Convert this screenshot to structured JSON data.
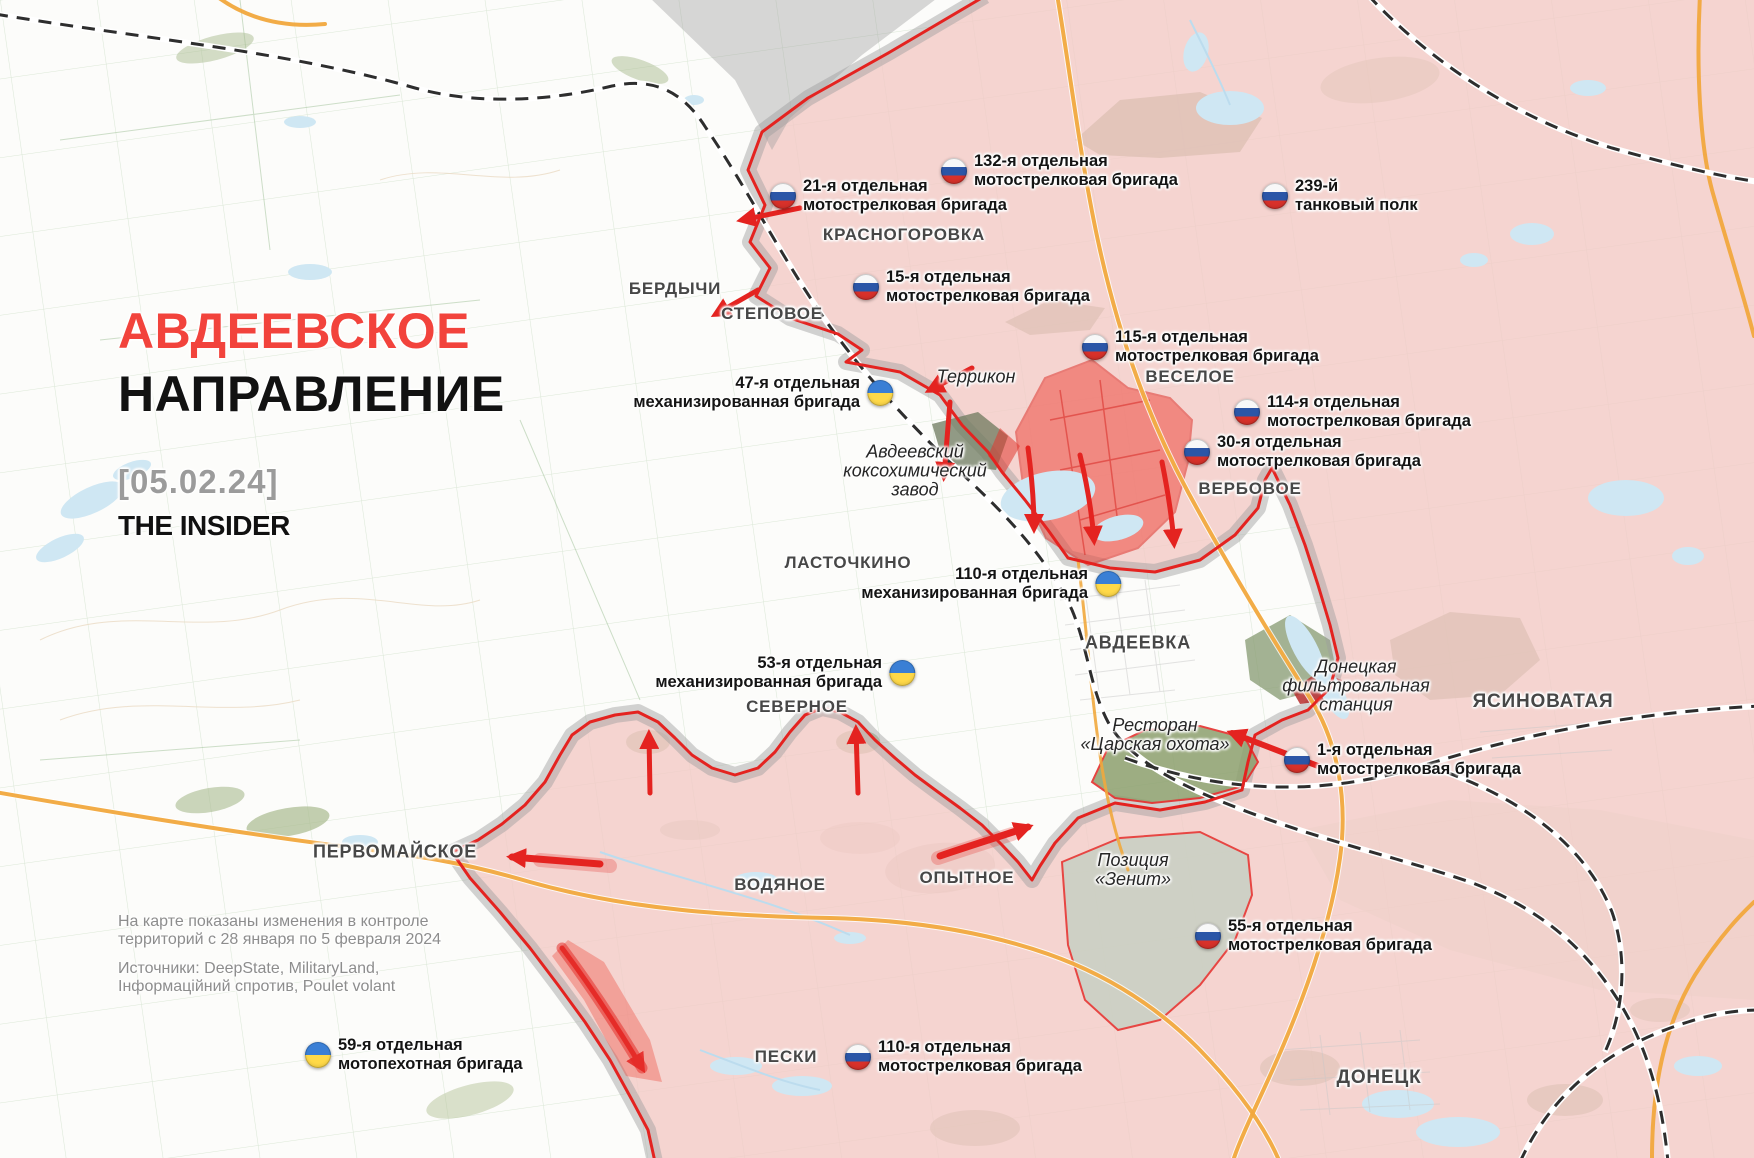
{
  "header": {
    "title_line1": "АВДЕЕВСКОЕ",
    "title_line2": "НАПРАВЛЕНИЕ",
    "date": "[05.02.24]",
    "brand": "THE INSIDER"
  },
  "legend_notes": {
    "line1": "На карте показаны изменения в контроле",
    "line2": "территорий с 28 января по 5 февраля 2024",
    "line3": "Источники: DeepState, MilitaryLand,",
    "line4": "Інформаційний спротив, Poulet volant"
  },
  "colors": {
    "title_red": "#f2433c",
    "date_gray": "#9b9b9b",
    "ru_controlled_pink": "#f2c9c6",
    "contested_gray": "#9e9e9e",
    "front_line_red": "#e42320",
    "captured_red": "#ef4135",
    "road_orange": "#f1a83d",
    "ru_flag_blue": "#2b56a7",
    "ru_flag_red": "#d8312a",
    "ua_flag_blue": "#3a7fd5",
    "ua_flag_yellow": "#ffd948"
  },
  "units": [
    {
      "id": "ru-21",
      "flag": "ru",
      "line1": "21-я отдельная",
      "line2": "мотострелковая бригада",
      "x": 783,
      "y": 196,
      "align": "left"
    },
    {
      "id": "ru-132",
      "flag": "ru",
      "line1": "132-я отдельная",
      "line2": "мотострелковая бригада",
      "x": 954,
      "y": 171,
      "align": "left"
    },
    {
      "id": "ru-239",
      "flag": "ru",
      "line1": "239-й",
      "line2": "танковый полк",
      "x": 1275,
      "y": 196,
      "align": "left"
    },
    {
      "id": "ru-15",
      "flag": "ru",
      "line1": "15-я отдельная",
      "line2": "мотострелковая бригада",
      "x": 866,
      "y": 287,
      "align": "left"
    },
    {
      "id": "ru-115",
      "flag": "ru",
      "line1": "115-я отдельная",
      "line2": "мотострелковая бригада",
      "x": 1095,
      "y": 347,
      "align": "left"
    },
    {
      "id": "ru-114",
      "flag": "ru",
      "line1": "114-я отдельная",
      "line2": "мотострелковая бригада",
      "x": 1247,
      "y": 412,
      "align": "left"
    },
    {
      "id": "ru-30",
      "flag": "ru",
      "line1": "30-я отдельная",
      "line2": "мотострелковая бригада",
      "x": 1197,
      "y": 452,
      "align": "left"
    },
    {
      "id": "ua-47",
      "flag": "ua",
      "line1": "47-я отдельная",
      "line2": "механизированная бригада",
      "x": 880,
      "y": 393,
      "align": "right"
    },
    {
      "id": "ua-110",
      "flag": "ua",
      "line1": "110-я отдельная",
      "line2": "механизированная бригада",
      "x": 1108,
      "y": 584,
      "align": "right"
    },
    {
      "id": "ua-53",
      "flag": "ua",
      "line1": "53-я отдельная",
      "line2": "механизированная бригада",
      "x": 902,
      "y": 673,
      "align": "right"
    },
    {
      "id": "ru-1",
      "flag": "ru",
      "line1": "1-я отдельная",
      "line2": "мотострелковая бригада",
      "x": 1297,
      "y": 760,
      "align": "left"
    },
    {
      "id": "ru-55",
      "flag": "ru",
      "line1": "55-я отдельная",
      "line2": "мотострелковая бригада",
      "x": 1208,
      "y": 936,
      "align": "left"
    },
    {
      "id": "ua-59",
      "flag": "ua",
      "line1": "59-я отдельная",
      "line2": "мотопехотная бригада",
      "x": 318,
      "y": 1055,
      "align": "left"
    },
    {
      "id": "ru-110",
      "flag": "ru",
      "line1": "110-я отдельная",
      "line2": "мотострелковая бригада",
      "x": 858,
      "y": 1057,
      "align": "left"
    }
  ],
  "cities": [
    {
      "name": "КРАСНОГОРОВКА",
      "x": 904,
      "y": 235,
      "size": 17
    },
    {
      "name": "БЕРДЫЧИ",
      "x": 675,
      "y": 289,
      "size": 17
    },
    {
      "name": "СТЕПОВОЕ",
      "x": 772,
      "y": 314,
      "size": 17
    },
    {
      "name": "ВЕСЕЛОЕ",
      "x": 1190,
      "y": 377,
      "size": 17
    },
    {
      "name": "ВЕРБОВОЕ",
      "x": 1250,
      "y": 489,
      "size": 17
    },
    {
      "name": "ЛАСТОЧКИНО",
      "x": 848,
      "y": 563,
      "size": 17
    },
    {
      "name": "АВДЕЕВКА",
      "x": 1138,
      "y": 643,
      "size": 18
    },
    {
      "name": "СЕВЕРНОЕ",
      "x": 797,
      "y": 707,
      "size": 17
    },
    {
      "name": "ЯСИНОВАТАЯ",
      "x": 1543,
      "y": 702,
      "size": 19
    },
    {
      "name": "ПЕРВОМАЙСКОЕ",
      "x": 395,
      "y": 852,
      "size": 18
    },
    {
      "name": "ВОДЯНОЕ",
      "x": 780,
      "y": 885,
      "size": 17
    },
    {
      "name": "ОПЫТНОЕ",
      "x": 967,
      "y": 878,
      "size": 17
    },
    {
      "name": "ПЕСКИ",
      "x": 786,
      "y": 1057,
      "size": 17
    },
    {
      "name": "ДОНЕЦК",
      "x": 1379,
      "y": 1078,
      "size": 19
    }
  ],
  "places": [
    {
      "id": "terrikon",
      "lines": [
        "Террикон"
      ],
      "x": 976,
      "y": 377
    },
    {
      "id": "koksohim",
      "lines": [
        "Авдеевский",
        "коксохимический",
        "завод"
      ],
      "x": 915,
      "y": 471
    },
    {
      "id": "filter-station",
      "lines": [
        "Донецкая",
        "фильтровальная",
        "станция"
      ],
      "x": 1356,
      "y": 686
    },
    {
      "id": "tsarska-ohota",
      "lines": [
        "Ресторан",
        "«Царская охота»"
      ],
      "x": 1155,
      "y": 735
    },
    {
      "id": "zenit",
      "lines": [
        "Позиция",
        "«Зенит»"
      ],
      "x": 1133,
      "y": 870
    }
  ]
}
